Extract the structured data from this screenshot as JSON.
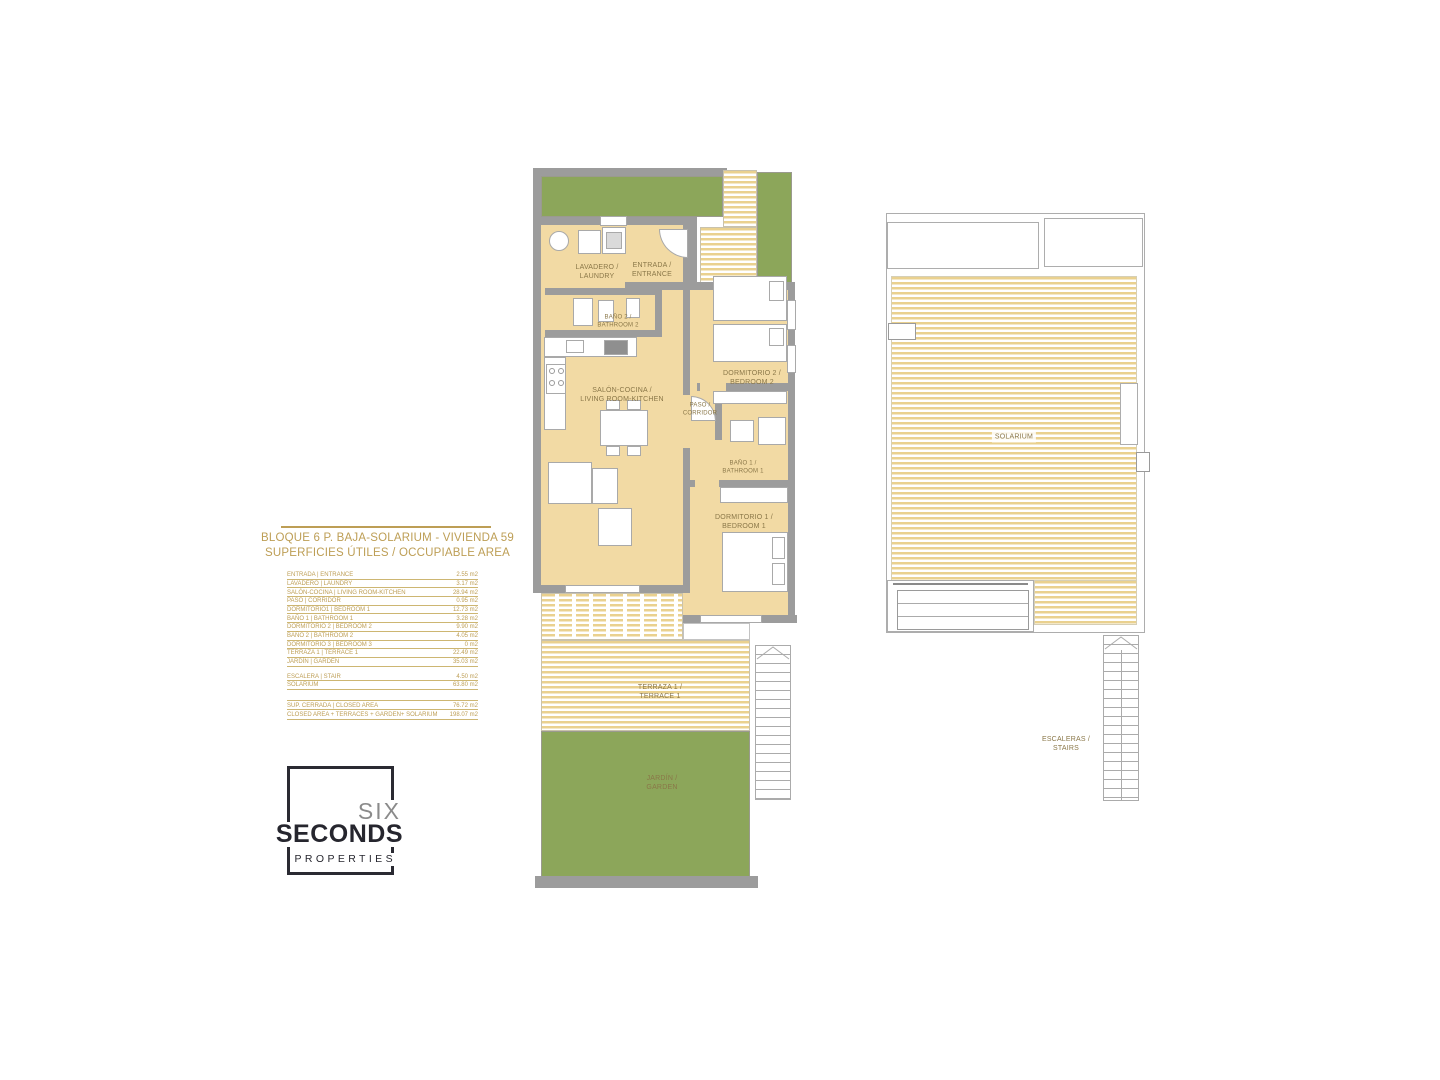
{
  "header": {
    "title": "BLOQUE 6 P. BAJA-SOLARIUM - VIVIENDA 59",
    "subtitle": "SUPERFICIES ÚTILES / OCCUPIABLE AREA"
  },
  "areas_table": {
    "rows": [
      {
        "label": "ENTRADA | ENTRANCE",
        "value": "2.55 m2"
      },
      {
        "label": "LAVADERO | LAUNDRY",
        "value": "3.17 m2"
      },
      {
        "label": "SALÓN-COCINA | LIVING ROOM-KITCHEN",
        "value": "28.94 m2"
      },
      {
        "label": "PASO | CORRIDOR",
        "value": "0.95 m2"
      },
      {
        "label": "DORMITORIO1 | BEDROOM 1",
        "value": "12.73 m2"
      },
      {
        "label": "BAÑO 1 | BATHROOM 1",
        "value": "3.28 m2"
      },
      {
        "label": "DORMITORIO 2 | BEDROOM 2",
        "value": "9.90 m2"
      },
      {
        "label": "BAÑO 2 | BATHROOM 2",
        "value": "4.05 m2"
      },
      {
        "label": "DORMITORIO 3 | BEDROOM 3",
        "value": "0 m2"
      },
      {
        "label": "TERRAZA 1 | TERRACE 1",
        "value": "22.49 m2"
      },
      {
        "label": "JARDÍN | GARDEN",
        "value": "35.03 m2"
      },
      {
        "label": "ESCALERA | STAIR",
        "value": "4.50 m2"
      },
      {
        "label": "SOLARIUM",
        "value": "63.80 m2"
      }
    ],
    "totals": [
      {
        "label": "SUP. CERRADA | CLOSED AREA",
        "value": "76.72 m2"
      },
      {
        "label": "CLOSED AREA + TERRACES + GARDEN+ SOLARIUM",
        "value": "198.07 m2"
      }
    ]
  },
  "logo": {
    "six": "SIX",
    "seconds": "SECONDS",
    "properties": "PROPERTIES"
  },
  "plan_ground": {
    "rooms": {
      "laundry": "LAVADERO /\nLAUNDRY",
      "entrance": "ENTRADA /\nENTRANCE",
      "bathroom2": "BAÑO 2 /\nBATHROOM 2",
      "living": "SALÓN-COCINA /\nLIVING ROOM-KITCHEN",
      "corridor": "PASO /\nCORRIDOR",
      "bedroom2": "DORMITORIO 2 /\nBEDROOM 2",
      "bathroom1": "BAÑO 1 /\nBATHROOM 1",
      "bedroom1": "DORMITORIO 1 /\nBEDROOM 1",
      "terrace": "TERRAZA 1 /\nTERRACE 1",
      "garden": "JARDÍN /\nGARDEN"
    }
  },
  "plan_solarium": {
    "rooms": {
      "solarium": "SOLARIUM",
      "stairs": "ESCALERAS /\nSTAIRS"
    }
  },
  "colors": {
    "accent_gold": "#BD9E55",
    "room_cream": "#F2DAA4",
    "stripe_yellow": "#EAD18F",
    "garden_green": "#8CA65A",
    "wall_gray": "#9C9C9C",
    "logo_dark": "#26262E",
    "logo_gray": "#8B8B8B"
  }
}
